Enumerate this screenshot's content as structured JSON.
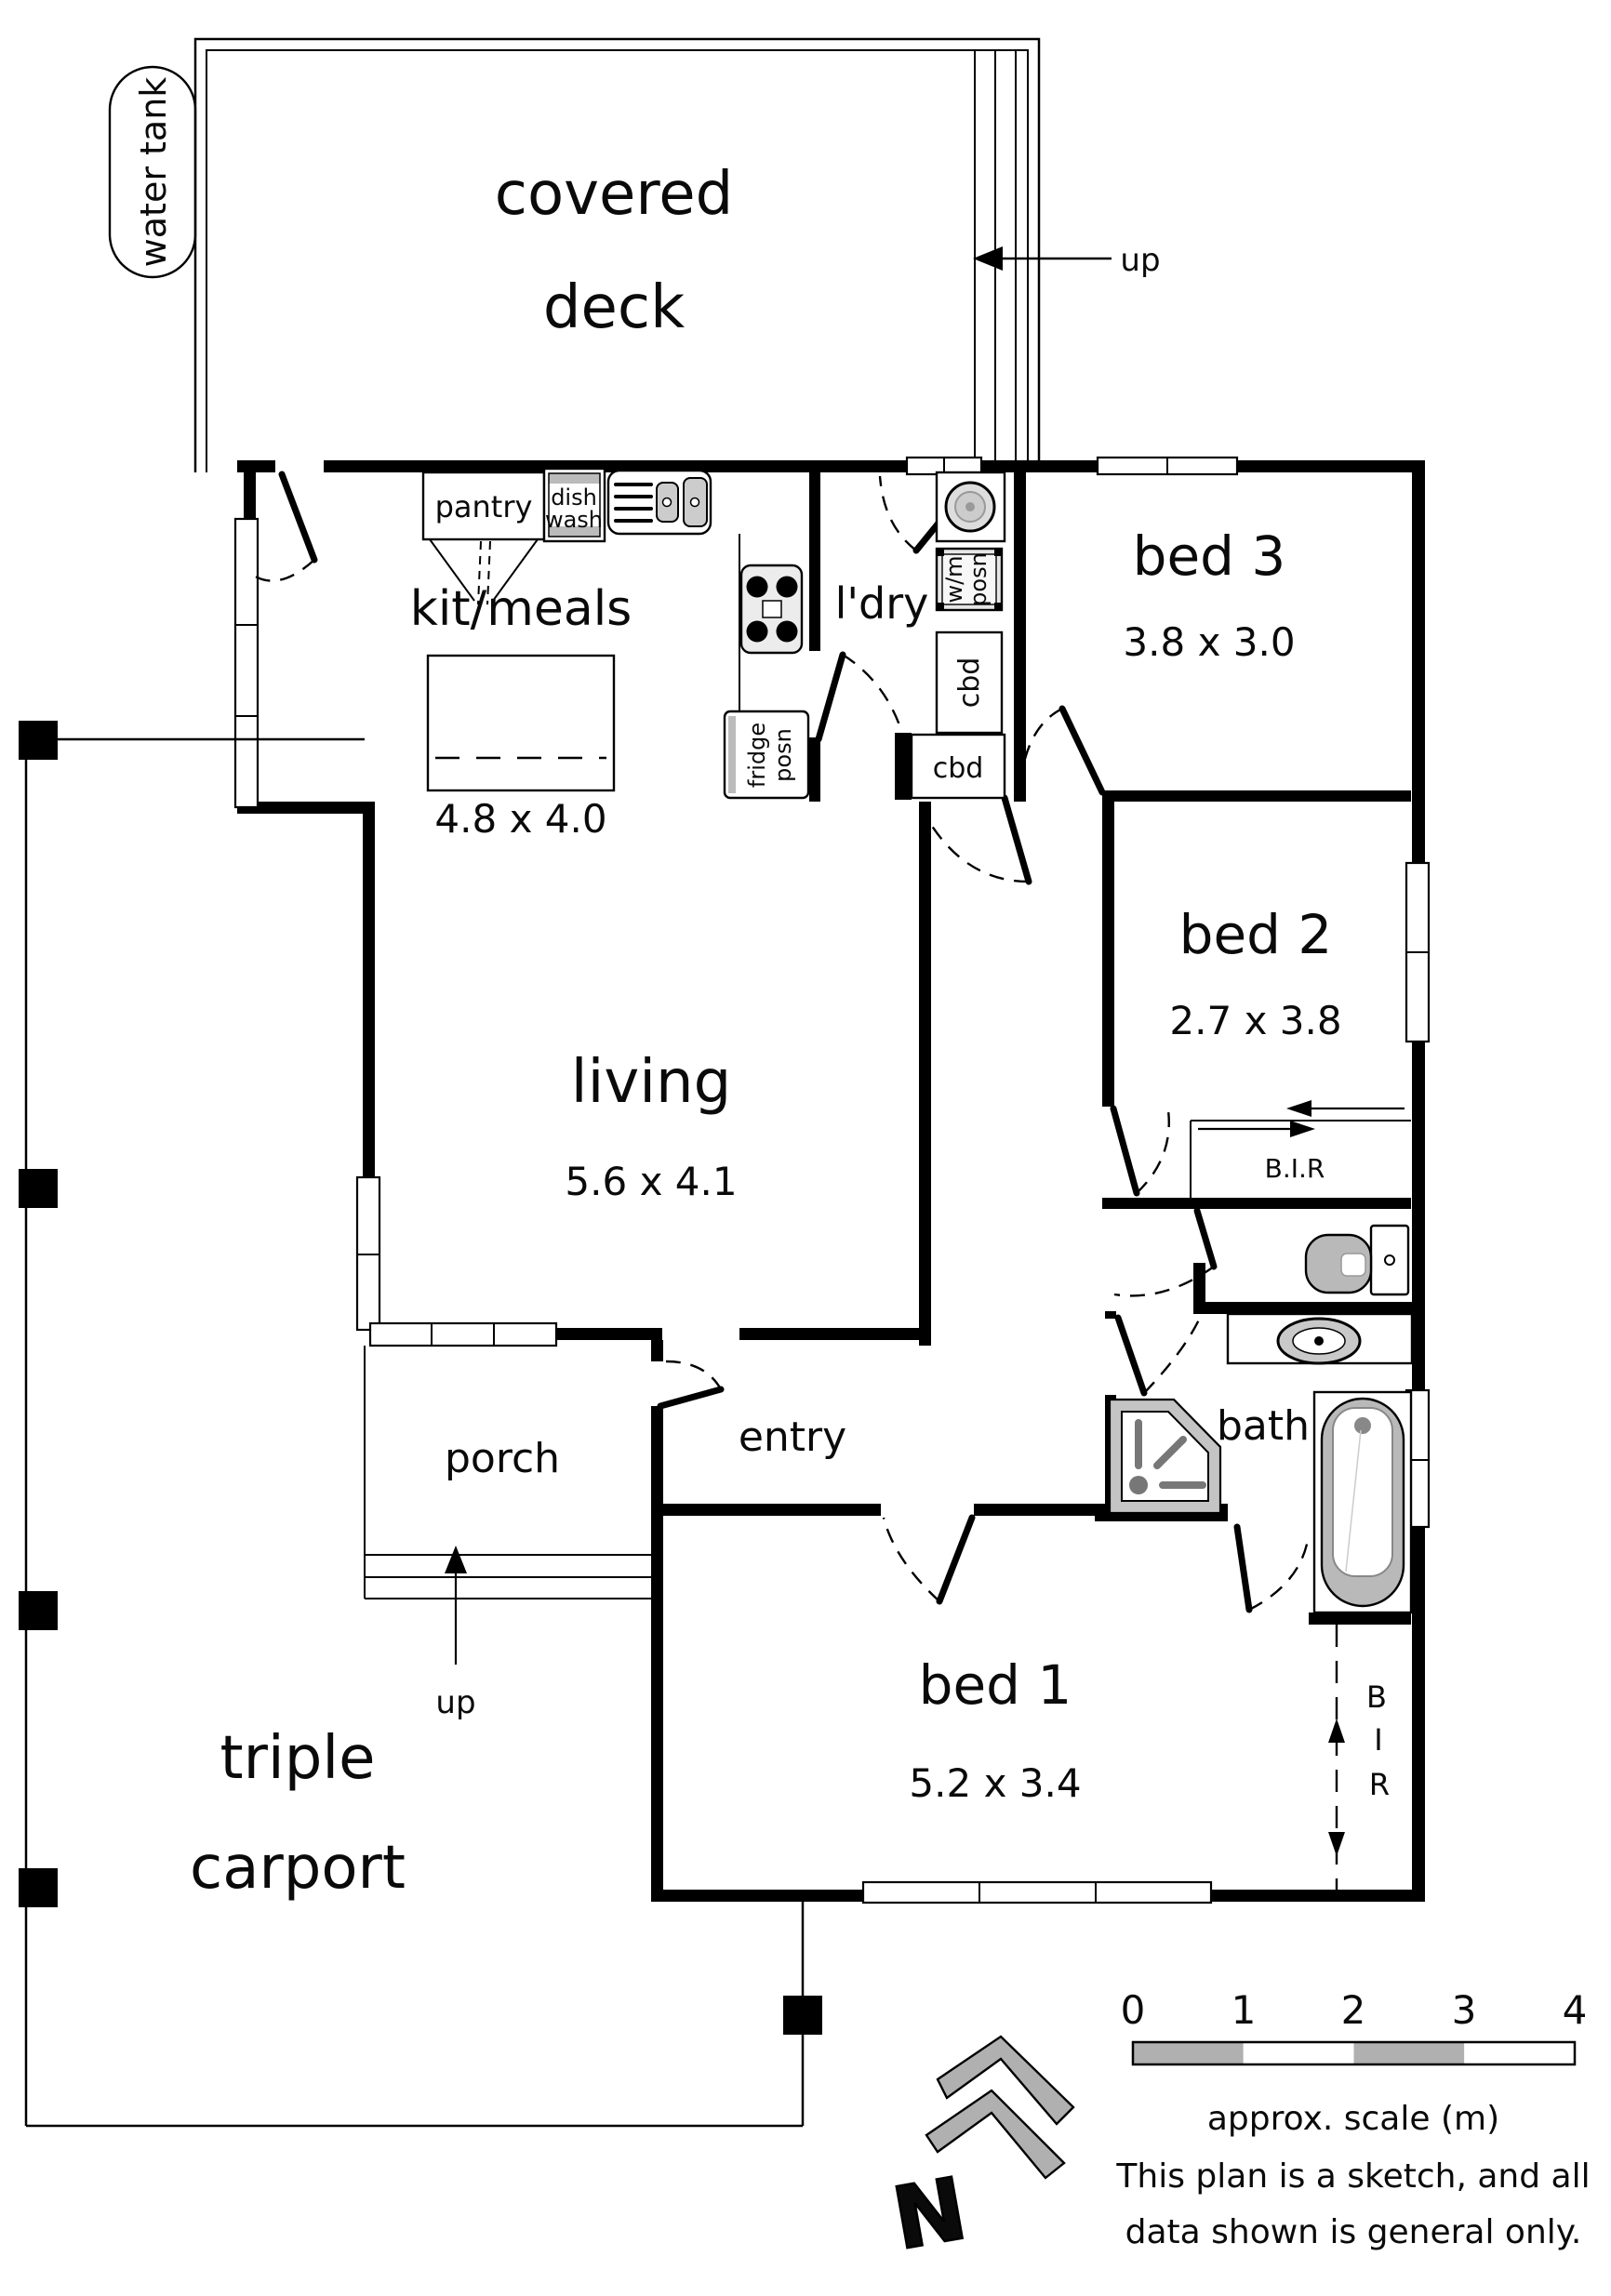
{
  "plan": {
    "water_tank": "water tank",
    "deck": {
      "label_line1": "covered",
      "label_line2": "deck",
      "up": "up"
    },
    "kitchen": {
      "label": "kit/meals",
      "dims": "4.8 x 4.0",
      "pantry": "pantry",
      "dish": "dish",
      "wash": "wash",
      "fridge_line1": "fridge",
      "fridge_line2": "posn"
    },
    "laundry": {
      "label": "l'dry",
      "wm_line1": "w/m",
      "wm_line2": "posn",
      "cbd_upper": "cbd",
      "cbd_lower": "cbd"
    },
    "bed3": {
      "label": "bed 3",
      "dims": "3.8 x 3.0"
    },
    "bed2": {
      "label": "bed 2",
      "dims": "2.7 x 3.8",
      "bir": "B.I.R"
    },
    "bath": {
      "label": "bath"
    },
    "living": {
      "label": "living",
      "dims": "5.6 x 4.1"
    },
    "entry": {
      "label": "entry"
    },
    "porch": {
      "label": "porch",
      "up": "up"
    },
    "bed1": {
      "label": "bed 1",
      "dims": "5.2 x 3.4",
      "bir_b": "B",
      "bir_i": "I",
      "bir_r": "R"
    },
    "carport": {
      "label_line1": "triple",
      "label_line2": "carport"
    },
    "compass": {
      "north": "N"
    },
    "scale": {
      "ticks": [
        "0",
        "1",
        "2",
        "3",
        "4"
      ],
      "caption": "approx. scale (m)",
      "note_line1": "This plan is a sketch, and all",
      "note_line2": "data shown is general only."
    }
  }
}
